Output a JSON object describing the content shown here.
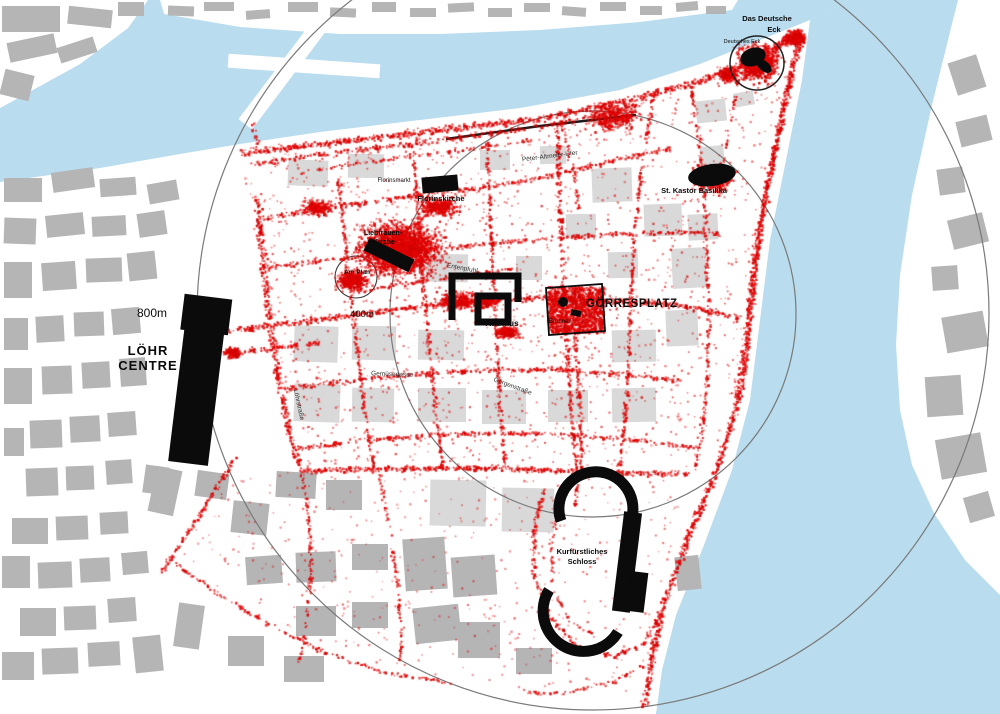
{
  "map": {
    "colors": {
      "trace": "#e00000",
      "water": "#b9dcee",
      "land": "#ffffff",
      "building": "#b5b5b5",
      "building_light": "#d9d9d9",
      "landmark": "#0b0b0b",
      "ring": "#7a7a7a"
    },
    "scale_rings": {
      "cx": 593,
      "cy": 314,
      "inner_r": 203,
      "outer_r": 396
    },
    "labels": {
      "eck": {
        "line1": "Das Deutsche",
        "line2": "Eck",
        "sub": "Deutsches Eck"
      },
      "kastor": "St. Kastor Basilika",
      "florinskirche": "Florinskirche",
      "florinsmarkt": "Florinsmarkt",
      "liebfrauen": {
        "line1": "Liebfrauen-",
        "line2": "Kirche"
      },
      "am_plan": "Am Plan",
      "rathaus": "Rathaus",
      "goerresplatz": "GÖRRESPLATZ",
      "brunnen": "Brunnen",
      "loehr": {
        "line1": "LÖHR",
        "line2": "CENTRE"
      },
      "schloss": {
        "line1": "Kurfürstliches",
        "line2": "Schloss"
      },
      "rings": {
        "outer": "800m",
        "inner": "400m"
      },
      "streets": {
        "entenpfuhl": "Entenpfuhl",
        "gemuesegasse": "Gemüsegasse",
        "goergenstrasse": "Görgenstraße",
        "loehrstrasse": "Löhrstraße",
        "ufer": "Peter-Altmeier-Ufer"
      }
    }
  }
}
